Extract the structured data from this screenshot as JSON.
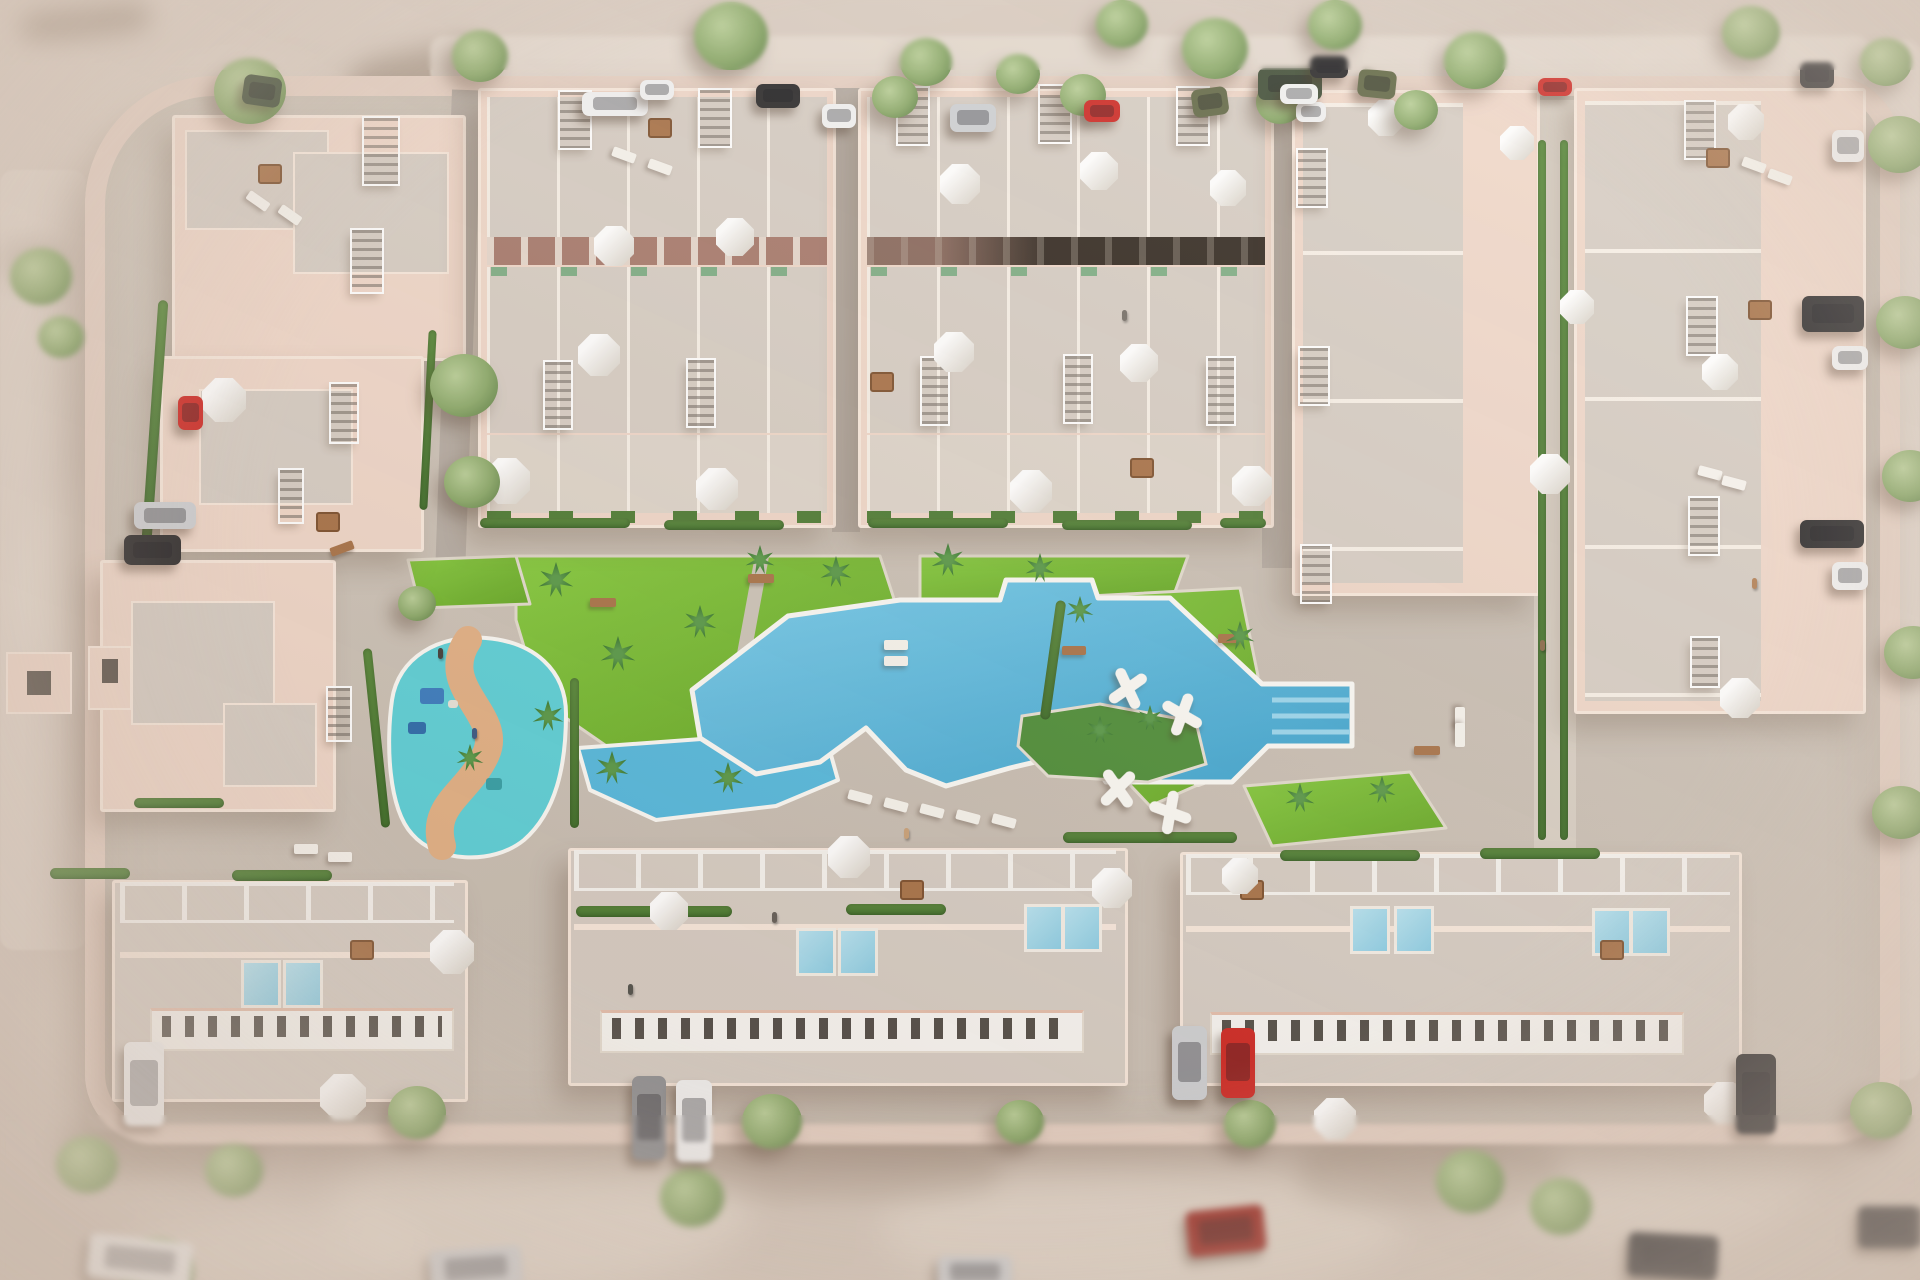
{
  "labels": {
    "scene": "aerial-3d-render-residential-complex-with-pool"
  },
  "palette": {
    "sand": "#d8cbc0",
    "sandLight": "#eae0d6",
    "site": "#cdc4b9",
    "sidewalk": "#e6d1c4",
    "road": "#b7aea5",
    "wallPink": "#f0d8ca",
    "wallPinkDeep": "#e5c0ae",
    "parapet": "#f8e9dd",
    "roofGray": "#d7cec5",
    "roofLight": "#ded5cb",
    "facade": "#a87b6e",
    "white": "#f8f6f2",
    "windowDark": "#55504a",
    "grass": "#74b92f",
    "grassLight": "#85ca3e",
    "hedge": "#4f7d36",
    "palm": "#3d7d35",
    "treeFoliage": "#8caa6b",
    "pool": "#5abade",
    "poolDeep": "#3ea4cf",
    "splash": "#5fd2d9",
    "splashPath": "#e3b287",
    "kidsPool": "#57badf",
    "island": "#4f8f3a",
    "wood": "#a9744a",
    "carWhite": "#f2f2f2",
    "carBlack": "#2c2b2c",
    "carGray": "#8f9093",
    "carSilver": "#cfd1d4",
    "carRed": "#cf2b26",
    "carDarkRed": "#9c2a22",
    "carOlive": "#646a48",
    "carGreen": "#43503a"
  },
  "svg_shapes": {
    "lawns": [
      "516,556 880,556 910,648 876,710 758,744 618,754 540,700 516,620",
      "920,556 1188,556 1172,600 1100,600 1092,580 1006,580 1000,600 920,600",
      "1052,598 1240,588 1258,676 1250,762 1150,806 1070,722",
      "1244,786 1410,772 1446,828 1272,846",
      "408,560 516,556 530,604 420,608"
    ],
    "walk_paths": [
      {
        "d": "M762,556 L726,752",
        "w": 14,
        "c": "#cdc5b9"
      },
      {
        "d": "M1076,716 C1120,676 1180,676 1222,712 C1252,740 1240,768 1198,782",
        "w": 10,
        "c": "#ece6dc"
      }
    ],
    "kids_pool": "578,748 824,730 838,780 776,806 656,820 590,790",
    "pool": "692,690 788,616 900,600 1000,600 1006,580 1092,580 1098,598 1170,598 1262,684 1352,684 1352,746 1268,746 1232,782 1106,782 1086,750 1010,768 946,786 906,770 866,728 820,762 756,774 700,738",
    "island": "1022,716 1100,704 1196,722 1206,764 1148,782 1048,776 1018,746",
    "steps": [
      "1272,700 1350,700",
      "1272,716 1350,716",
      "1272,732 1350,732"
    ],
    "splash_blob": "M392,700 C398,658 438,634 486,638 C534,642 566,670 566,714 C566,766 556,812 524,840 C492,866 436,862 412,834 C388,808 386,742 392,700 Z",
    "splash_path": "M468,640 C436,688 504,714 486,754 C468,794 430,804 442,846",
    "toys": [
      [
        420,
        688,
        24,
        16,
        "#3d7ec0"
      ],
      [
        408,
        722,
        18,
        12,
        "#2f6dad"
      ],
      [
        486,
        778,
        16,
        12,
        "#37a2a8"
      ],
      [
        448,
        700,
        10,
        8,
        "#e8e4da"
      ]
    ]
  },
  "items": {
    "trees": [
      [
        214,
        58,
        72,
        0
      ],
      [
        452,
        30,
        56,
        0
      ],
      [
        694,
        2,
        74,
        0
      ],
      [
        900,
        38,
        52,
        0
      ],
      [
        1096,
        0,
        52,
        0
      ],
      [
        1182,
        18,
        66,
        0
      ],
      [
        1308,
        0,
        54,
        0
      ],
      [
        1444,
        32,
        62,
        0
      ],
      [
        1722,
        6,
        58,
        0
      ],
      [
        1860,
        38,
        52,
        0
      ],
      [
        872,
        76,
        46,
        0
      ],
      [
        996,
        54,
        44,
        0
      ],
      [
        1060,
        74,
        46,
        0
      ],
      [
        1256,
        80,
        48,
        0
      ],
      [
        1394,
        90,
        44,
        0
      ],
      [
        10,
        248,
        62,
        1
      ],
      [
        38,
        316,
        46,
        1
      ],
      [
        430,
        354,
        68,
        0
      ],
      [
        444,
        456,
        56,
        0
      ],
      [
        398,
        586,
        38,
        0
      ],
      [
        1868,
        116,
        62,
        0
      ],
      [
        1876,
        296,
        58,
        0
      ],
      [
        1882,
        450,
        56,
        0
      ],
      [
        1884,
        626,
        58,
        0
      ],
      [
        1872,
        786,
        58,
        0
      ],
      [
        388,
        1086,
        58,
        0
      ],
      [
        742,
        1094,
        60,
        0
      ],
      [
        996,
        1100,
        48,
        0
      ],
      [
        1224,
        1100,
        52,
        0
      ],
      [
        1436,
        1150,
        68,
        1
      ],
      [
        56,
        1136,
        62,
        1
      ],
      [
        205,
        1144,
        58,
        1
      ],
      [
        660,
        1168,
        64,
        1
      ],
      [
        1850,
        1082,
        62,
        0
      ],
      [
        120,
        1238,
        74,
        1
      ],
      [
        1530,
        1178,
        62,
        1
      ]
    ],
    "palms": [
      [
        556,
        580,
        36
      ],
      [
        618,
        654,
        36
      ],
      [
        700,
        622,
        34
      ],
      [
        548,
        716,
        32
      ],
      [
        836,
        572,
        32
      ],
      [
        948,
        560,
        34
      ],
      [
        1040,
        568,
        30
      ],
      [
        612,
        768,
        34
      ],
      [
        728,
        778,
        32
      ],
      [
        1100,
        730,
        28
      ],
      [
        1150,
        718,
        26
      ],
      [
        1300,
        798,
        30
      ],
      [
        1382,
        790,
        28
      ],
      [
        1240,
        636,
        30
      ],
      [
        1080,
        610,
        28
      ],
      [
        470,
        758,
        28
      ],
      [
        760,
        560,
        30
      ]
    ],
    "umbrellas": [
      [
        594,
        226,
        40
      ],
      [
        716,
        218,
        38
      ],
      [
        578,
        334,
        42
      ],
      [
        484,
        458,
        46
      ],
      [
        696,
        468,
        42
      ],
      [
        940,
        164,
        40
      ],
      [
        1080,
        152,
        38
      ],
      [
        1210,
        170,
        36
      ],
      [
        934,
        332,
        40
      ],
      [
        1120,
        344,
        38
      ],
      [
        1232,
        466,
        40
      ],
      [
        1010,
        470,
        42
      ],
      [
        202,
        378,
        44
      ],
      [
        430,
        930,
        44
      ],
      [
        828,
        836,
        42
      ],
      [
        650,
        892,
        38
      ],
      [
        1092,
        868,
        40
      ],
      [
        1222,
        858,
        36
      ],
      [
        1314,
        1098,
        42
      ],
      [
        1704,
        1082,
        42
      ],
      [
        320,
        1074,
        46
      ],
      [
        1500,
        126,
        34
      ],
      [
        1560,
        290,
        34
      ],
      [
        1530,
        454,
        40
      ],
      [
        1728,
        104,
        36
      ],
      [
        1702,
        354,
        36
      ],
      [
        1720,
        678,
        40
      ],
      [
        1368,
        100,
        36
      ]
    ],
    "grates": [
      [
        364,
        118,
        34,
        66,
        0
      ],
      [
        352,
        230,
        30,
        62,
        0
      ],
      [
        331,
        384,
        26,
        58,
        0
      ],
      [
        280,
        470,
        22,
        52,
        0
      ],
      [
        328,
        688,
        22,
        52,
        0
      ],
      [
        560,
        92,
        30,
        56,
        0
      ],
      [
        700,
        90,
        30,
        56,
        0
      ],
      [
        898,
        88,
        30,
        56,
        0
      ],
      [
        1040,
        86,
        30,
        56,
        0
      ],
      [
        1178,
        88,
        30,
        56,
        0
      ],
      [
        545,
        362,
        26,
        66,
        0
      ],
      [
        688,
        360,
        26,
        66,
        0
      ],
      [
        922,
        358,
        26,
        66,
        0
      ],
      [
        1065,
        356,
        26,
        66,
        0
      ],
      [
        1208,
        358,
        26,
        66,
        0
      ],
      [
        1298,
        150,
        28,
        56,
        0
      ],
      [
        1300,
        348,
        28,
        56,
        0
      ],
      [
        1302,
        546,
        28,
        56,
        0
      ],
      [
        1686,
        102,
        28,
        56,
        0
      ],
      [
        1688,
        298,
        28,
        56,
        0
      ],
      [
        1690,
        498,
        28,
        56,
        0
      ],
      [
        1692,
        638,
        26,
        48,
        0
      ]
    ],
    "hedges": [
      [
        480,
        518,
        150,
        10,
        0
      ],
      [
        664,
        520,
        120,
        10,
        0
      ],
      [
        868,
        518,
        140,
        10,
        0
      ],
      [
        1062,
        520,
        130,
        10,
        0
      ],
      [
        1220,
        518,
        46,
        10,
        0
      ],
      [
        576,
        906,
        156,
        11,
        0
      ],
      [
        846,
        904,
        100,
        11,
        0
      ],
      [
        1063,
        832,
        174,
        11,
        0
      ],
      [
        232,
        870,
        100,
        11,
        0
      ],
      [
        50,
        868,
        80,
        11,
        0
      ],
      [
        134,
        798,
        90,
        10,
        0
      ],
      [
        372,
        648,
        9,
        180,
        -6
      ],
      [
        570,
        678,
        9,
        150,
        0
      ],
      [
        1538,
        140,
        8,
        700,
        0
      ],
      [
        1560,
        140,
        8,
        700,
        0
      ],
      [
        150,
        300,
        10,
        240,
        4
      ],
      [
        1048,
        600,
        10,
        120,
        8
      ],
      [
        424,
        330,
        8,
        180,
        3
      ],
      [
        1280,
        850,
        140,
        11,
        0
      ],
      [
        1480,
        848,
        120,
        11,
        0
      ]
    ],
    "cars": [
      [
        582,
        92,
        66,
        24,
        "carWhite",
        0,
        0
      ],
      [
        640,
        80,
        34,
        20,
        "carWhite",
        0,
        0
      ],
      [
        756,
        84,
        44,
        24,
        "carBlack",
        0,
        0
      ],
      [
        822,
        104,
        34,
        24,
        "carWhite",
        0,
        0
      ],
      [
        950,
        104,
        46,
        28,
        "carSilver",
        0,
        0
      ],
      [
        1084,
        100,
        36,
        22,
        "carRed",
        0,
        0
      ],
      [
        1192,
        88,
        36,
        28,
        "carOlive",
        -8,
        0
      ],
      [
        1258,
        68,
        64,
        32,
        "carGreen",
        0,
        0
      ],
      [
        1296,
        102,
        30,
        20,
        "carWhite",
        0,
        0
      ],
      [
        1310,
        56,
        38,
        22,
        "carBlack",
        0,
        0
      ],
      [
        1358,
        70,
        38,
        28,
        "carOlive",
        6,
        0
      ],
      [
        1280,
        84,
        38,
        20,
        "carWhite",
        0,
        0
      ],
      [
        1538,
        78,
        34,
        18,
        "carRed",
        0,
        0
      ],
      [
        1800,
        62,
        34,
        26,
        "carBlack",
        0,
        0
      ],
      [
        243,
        76,
        38,
        30,
        "carGreen",
        8,
        0
      ],
      [
        178,
        396,
        25,
        34,
        "carRed",
        0,
        0
      ],
      [
        134,
        502,
        62,
        27,
        "carSilver",
        0,
        0
      ],
      [
        124,
        535,
        57,
        30,
        "carBlack",
        0,
        0
      ],
      [
        1802,
        296,
        62,
        36,
        "carBlack",
        0,
        0
      ],
      [
        1832,
        346,
        36,
        24,
        "carWhite",
        0,
        0
      ],
      [
        1800,
        520,
        64,
        28,
        "carBlack",
        0,
        0
      ],
      [
        1832,
        562,
        36,
        28,
        "carWhite",
        0,
        0
      ],
      [
        1832,
        130,
        32,
        32,
        "carWhite",
        0,
        0
      ],
      [
        124,
        1042,
        40,
        84,
        "carWhite",
        0,
        0
      ],
      [
        632,
        1076,
        34,
        84,
        "carGray",
        0,
        0
      ],
      [
        676,
        1080,
        36,
        82,
        "carWhite",
        0,
        0
      ],
      [
        1172,
        1026,
        35,
        74,
        "carSilver",
        0,
        0
      ],
      [
        1221,
        1028,
        34,
        70,
        "carRed",
        0,
        0
      ],
      [
        1736,
        1054,
        40,
        80,
        "carBlack",
        0,
        0
      ],
      [
        1187,
        1208,
        78,
        46,
        "carDarkRed",
        -6,
        1
      ],
      [
        88,
        1238,
        104,
        44,
        "carWhite",
        6,
        1
      ],
      [
        430,
        1248,
        92,
        40,
        "carSilver",
        -4,
        1
      ],
      [
        1628,
        1234,
        90,
        44,
        "carBlack",
        3,
        1
      ],
      [
        1858,
        1206,
        62,
        42,
        "carBlack",
        0,
        1
      ],
      [
        938,
        1256,
        74,
        32,
        "carSilver",
        0,
        1
      ]
    ],
    "mini_pools": [
      [
        241,
        960
      ],
      [
        283,
        960
      ],
      [
        796,
        928
      ],
      [
        838,
        928
      ],
      [
        1024,
        904
      ],
      [
        1062,
        904
      ],
      [
        1350,
        906
      ],
      [
        1394,
        906
      ],
      [
        1592,
        908
      ],
      [
        1630,
        908
      ]
    ],
    "loungers": [
      [
        848,
        792,
        15
      ],
      [
        884,
        800,
        15
      ],
      [
        920,
        806,
        15
      ],
      [
        956,
        812,
        15
      ],
      [
        992,
        816,
        15
      ],
      [
        884,
        640,
        0
      ],
      [
        884,
        656,
        0
      ],
      [
        1448,
        714,
        90
      ],
      [
        1448,
        730,
        90
      ],
      [
        246,
        196,
        35
      ],
      [
        278,
        210,
        35
      ],
      [
        612,
        150,
        20
      ],
      [
        648,
        162,
        20
      ],
      [
        1742,
        160,
        20
      ],
      [
        1768,
        172,
        20
      ],
      [
        1698,
        468,
        15
      ],
      [
        1722,
        478,
        15
      ],
      [
        294,
        844,
        0
      ],
      [
        328,
        852,
        0
      ]
    ],
    "tables": [
      [
        258,
        164
      ],
      [
        648,
        118
      ],
      [
        1706,
        148
      ],
      [
        1748,
        300
      ],
      [
        870,
        372
      ],
      [
        1130,
        458
      ],
      [
        316,
        512
      ],
      [
        350,
        940
      ],
      [
        900,
        880
      ],
      [
        1240,
        880
      ],
      [
        1600,
        940
      ]
    ],
    "benches": [
      [
        590,
        598,
        26,
        0
      ],
      [
        748,
        574,
        26,
        0
      ],
      [
        1062,
        646,
        24,
        0
      ],
      [
        1218,
        634,
        24,
        0
      ],
      [
        1414,
        746,
        26,
        0
      ],
      [
        330,
        544,
        24,
        -20
      ]
    ],
    "sculptures": [
      [
        1104,
        664,
        15
      ],
      [
        1158,
        690,
        -20
      ],
      [
        1094,
        764,
        5
      ],
      [
        1146,
        788,
        -30
      ]
    ],
    "people": [
      [
        904,
        828,
        "#caa27a"
      ],
      [
        472,
        728,
        "#3c5a84"
      ],
      [
        1752,
        578,
        "#b5835a"
      ],
      [
        628,
        984,
        "#555550"
      ],
      [
        772,
        912,
        "#66605a"
      ],
      [
        1122,
        310,
        "#77706a"
      ],
      [
        1540,
        640,
        "#8a6a4a"
      ],
      [
        438,
        648,
        "#44403c"
      ]
    ],
    "light_blobs": [
      [
        70,
        70,
        320,
        220,
        0.5
      ],
      [
        10,
        470,
        280,
        240,
        0.45
      ],
      [
        500,
        130,
        220,
        130,
        0.4
      ],
      [
        330,
        1120,
        420,
        170,
        0.5
      ],
      [
        880,
        1160,
        520,
        140,
        0.45
      ],
      [
        1480,
        1060,
        340,
        190,
        0.4
      ],
      [
        40,
        880,
        220,
        320,
        0.4
      ],
      [
        1600,
        20,
        260,
        120,
        0.3
      ],
      [
        120,
        1210,
        300,
        90,
        0.5
      ]
    ],
    "shadow_blobs": [
      [
        350,
        50,
        130,
        48,
        0.5,
        -12
      ],
      [
        20,
        6,
        130,
        32,
        0.55,
        -6
      ],
      [
        430,
        240,
        60,
        110,
        0.3,
        18
      ],
      [
        0,
        240,
        66,
        42,
        0.55,
        0
      ],
      [
        1450,
        120,
        200,
        60,
        0.22,
        -4
      ],
      [
        700,
        1130,
        300,
        70,
        0.22,
        0
      ],
      [
        1300,
        1140,
        260,
        70,
        0.22,
        0
      ],
      [
        60,
        1120,
        200,
        60,
        0.28,
        0
      ]
    ]
  }
}
